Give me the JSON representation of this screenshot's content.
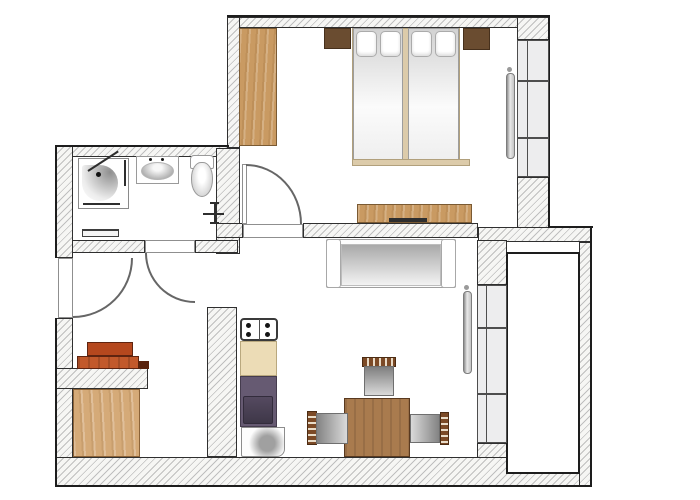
{
  "canvas": {
    "w": 700,
    "h": 500,
    "background": "#ffffff"
  },
  "plan_type": "apartment-floor-plan",
  "palette": {
    "wall_hatch_line": "#bfbfbf",
    "wall_outline": "#2f2f2f",
    "boundary": "#1d1d1d",
    "window_fill": "#ededee",
    "wood_light": "#c99a62",
    "wood_dark": "#6a4c30",
    "table_wood": "#a97b4e",
    "rack_orange": "#c2592b",
    "kitchen_counter": "#ecdcb6",
    "kitchen_purple": "#665a72",
    "radiator_gray": "#8f8f8f",
    "seat_gray": "#838383"
  },
  "elements": [
    {
      "name": "wall-bedroom-top",
      "cls": "wall",
      "x": 227,
      "y": 17,
      "w": 323,
      "h": 11
    },
    {
      "name": "wall-bedroom-top-corner",
      "cls": "wall",
      "x": 517,
      "y": 17,
      "w": 33,
      "h": 23
    },
    {
      "name": "wall-bedroom-left",
      "cls": "wall",
      "x": 227,
      "y": 17,
      "w": 13,
      "h": 131
    },
    {
      "name": "wall-bathroom-top",
      "cls": "wall",
      "x": 64,
      "y": 146,
      "w": 164,
      "h": 11
    },
    {
      "name": "wall-bathroom-right",
      "cls": "wall",
      "x": 216,
      "y": 148,
      "w": 24,
      "h": 106
    },
    {
      "name": "wall-left-upper",
      "cls": "wall",
      "x": 56,
      "y": 146,
      "w": 17,
      "h": 112
    },
    {
      "name": "wall-left-lower",
      "cls": "wall",
      "x": 56,
      "y": 318,
      "w": 17,
      "h": 140
    },
    {
      "name": "wall-bathroom-bottom-left",
      "cls": "wall",
      "x": 72,
      "y": 240,
      "w": 73,
      "h": 13
    },
    {
      "name": "wall-bathroom-bottom-right",
      "cls": "wall",
      "x": 195,
      "y": 240,
      "w": 43,
      "h": 13
    },
    {
      "name": "wall-living-top-left",
      "cls": "wall",
      "x": 216,
      "y": 223,
      "w": 27,
      "h": 15
    },
    {
      "name": "wall-living-top-main",
      "cls": "wall",
      "x": 303,
      "y": 223,
      "w": 175,
      "h": 15
    },
    {
      "name": "wall-connector-right",
      "cls": "wall",
      "x": 478,
      "y": 227,
      "w": 114,
      "h": 15
    },
    {
      "name": "wall-under-bedroom-window",
      "cls": "wall",
      "x": 517,
      "y": 177,
      "w": 33,
      "h": 51
    },
    {
      "name": "wall-balcony-column",
      "cls": "wall",
      "x": 477,
      "y": 240,
      "w": 30,
      "h": 45
    },
    {
      "name": "wall-under-living-window",
      "cls": "wall",
      "x": 477,
      "y": 443,
      "w": 30,
      "h": 15
    },
    {
      "name": "wall-outer-right",
      "cls": "wall",
      "x": 579,
      "y": 242,
      "w": 13,
      "h": 245
    },
    {
      "name": "wall-bottom",
      "cls": "wall",
      "x": 56,
      "y": 457,
      "w": 524,
      "h": 29
    },
    {
      "name": "wall-kitchen-stub",
      "cls": "wall",
      "x": 207,
      "y": 307,
      "w": 30,
      "h": 150
    },
    {
      "name": "wall-shoe-rack",
      "cls": "wall",
      "x": 56,
      "y": 368,
      "w": 92,
      "h": 21
    },
    {
      "name": "balcony-floor",
      "cls": "balcony",
      "x": 506,
      "y": 252,
      "w": 74,
      "h": 222
    },
    {
      "name": "boundary-top",
      "cls": "bline",
      "x": 227,
      "y": 15,
      "w": 323,
      "h": 2
    },
    {
      "name": "boundary-right-upper",
      "cls": "bline",
      "x": 548,
      "y": 15,
      "w": 2,
      "h": 213
    },
    {
      "name": "boundary-step-top",
      "cls": "bline",
      "x": 548,
      "y": 226,
      "w": 45,
      "h": 2
    },
    {
      "name": "boundary-outer-right",
      "cls": "bline",
      "x": 590,
      "y": 226,
      "w": 2,
      "h": 261
    },
    {
      "name": "boundary-bottom",
      "cls": "bline",
      "x": 56,
      "y": 485,
      "w": 536,
      "h": 2
    },
    {
      "name": "boundary-left-upper",
      "cls": "bline",
      "x": 55,
      "y": 145,
      "w": 2,
      "h": 113
    },
    {
      "name": "boundary-left-lower",
      "cls": "bline",
      "x": 55,
      "y": 318,
      "w": 2,
      "h": 169
    },
    {
      "name": "boundary-bathroom-top",
      "cls": "bline",
      "x": 55,
      "y": 145,
      "w": 174,
      "h": 2
    },
    {
      "name": "window-bedroom-cell-1",
      "cls": "wincell",
      "x": 517,
      "y": 40,
      "w": 32,
      "h": 41
    },
    {
      "name": "window-bedroom-cell-2",
      "cls": "wincell",
      "x": 517,
      "y": 81,
      "w": 32,
      "h": 57
    },
    {
      "name": "window-bedroom-cell-3",
      "cls": "wincell",
      "x": 517,
      "y": 138,
      "w": 32,
      "h": 39
    },
    {
      "name": "window-bedroom-mullion",
      "cls": "mull",
      "x": 527,
      "y": 40,
      "w": 1,
      "h": 137
    },
    {
      "name": "window-living-cell-1",
      "cls": "wincell",
      "x": 477,
      "y": 285,
      "w": 30,
      "h": 43
    },
    {
      "name": "window-living-cell-2",
      "cls": "wincell",
      "x": 477,
      "y": 328,
      "w": 30,
      "h": 66
    },
    {
      "name": "window-living-cell-3",
      "cls": "wincell",
      "x": 477,
      "y": 394,
      "w": 30,
      "h": 49
    },
    {
      "name": "window-living-mullion",
      "cls": "mull",
      "x": 486,
      "y": 285,
      "w": 1,
      "h": 158
    },
    {
      "name": "entry-door-leaf",
      "cls": "gap",
      "x": 58,
      "y": 258,
      "w": 15,
      "h": 60
    },
    {
      "name": "bathroom-door-leaf",
      "cls": "gap",
      "x": 145,
      "y": 240,
      "w": 50,
      "h": 13
    },
    {
      "name": "bedroom-door-threshold",
      "cls": "gap",
      "x": 243,
      "y": 224,
      "w": 60,
      "h": 14
    },
    {
      "name": "bedroom-door-leaf",
      "cls": "gap",
      "x": 242,
      "y": 164,
      "w": 5,
      "h": 60
    },
    {
      "name": "entry-door-swing-arc",
      "cls": "arc br",
      "x": 73,
      "y": 258,
      "w": 60,
      "h": 60
    },
    {
      "name": "bathroom-door-swing-arc",
      "cls": "arc bl",
      "x": 145,
      "y": 253,
      "w": 50,
      "h": 50
    },
    {
      "name": "bedroom-door-swing-arc",
      "cls": "arc tr",
      "x": 246,
      "y": 164,
      "w": 56,
      "h": 60
    },
    {
      "name": "radiator-bedroom",
      "cls": "radiator",
      "x": 506,
      "y": 73,
      "w": 9,
      "h": 86
    },
    {
      "name": "radiator-bedroom-valve",
      "cls": "dot-sm",
      "x": 507,
      "y": 67,
      "w": 5,
      "h": 5
    },
    {
      "name": "radiator-living",
      "cls": "radiator",
      "x": 463,
      "y": 291,
      "w": 9,
      "h": 83
    },
    {
      "name": "radiator-living-valve",
      "cls": "dot-sm",
      "x": 464,
      "y": 285,
      "w": 5,
      "h": 5
    },
    {
      "name": "wardrobe",
      "cls": "wood-light",
      "x": 239,
      "y": 28,
      "w": 38,
      "h": 118
    },
    {
      "name": "nightstand-left",
      "cls": "wood-dark",
      "x": 324,
      "y": 28,
      "w": 27,
      "h": 21
    },
    {
      "name": "nightstand-right",
      "cls": "wood-dark",
      "x": 463,
      "y": 28,
      "w": 27,
      "h": 22
    },
    {
      "name": "bed-frame",
      "cls": "bed-frame",
      "x": 352,
      "y": 28,
      "w": 108,
      "h": 137
    },
    {
      "name": "bed-mattress-left",
      "cls": "mattress",
      "x": 353,
      "y": 28,
      "w": 50,
      "h": 132
    },
    {
      "name": "bed-mattress-right",
      "cls": "mattress",
      "x": 408,
      "y": 28,
      "w": 51,
      "h": 132
    },
    {
      "name": "bed-footboard",
      "cls": "bed-frame",
      "x": 352,
      "y": 159,
      "w": 118,
      "h": 7
    },
    {
      "name": "pillow-1",
      "cls": "pillow",
      "x": 356,
      "y": 31,
      "w": 21,
      "h": 26
    },
    {
      "name": "pillow-2",
      "cls": "pillow",
      "x": 380,
      "y": 31,
      "w": 21,
      "h": 26
    },
    {
      "name": "pillow-3",
      "cls": "pillow",
      "x": 411,
      "y": 31,
      "w": 21,
      "h": 26
    },
    {
      "name": "pillow-4",
      "cls": "pillow",
      "x": 435,
      "y": 31,
      "w": 21,
      "h": 26
    },
    {
      "name": "dresser",
      "cls": "wood-light",
      "x": 357,
      "y": 204,
      "w": 115,
      "h": 19
    },
    {
      "name": "dresser-handle",
      "cls": "dark-strip",
      "x": 389,
      "y": 218,
      "w": 38,
      "h": 4
    },
    {
      "name": "sofa-body",
      "cls": "sofa",
      "x": 326,
      "y": 239,
      "w": 130,
      "h": 49
    },
    {
      "name": "sofa-seat",
      "cls": "seat-down-light",
      "x": 341,
      "y": 244,
      "w": 100,
      "h": 42
    },
    {
      "name": "sofa-armrest-left",
      "cls": "sofa-arm",
      "x": 326,
      "y": 239,
      "w": 15,
      "h": 49
    },
    {
      "name": "sofa-armrest-right",
      "cls": "sofa-arm",
      "x": 441,
      "y": 239,
      "w": 15,
      "h": 49
    },
    {
      "name": "stove",
      "cls": "stove",
      "x": 240,
      "y": 318,
      "w": 38,
      "h": 23
    },
    {
      "name": "stove-divider",
      "cls": "mull",
      "x": 259,
      "y": 319,
      "w": 1,
      "h": 21
    },
    {
      "name": "burner-1",
      "cls": "burner",
      "x": 246,
      "y": 323,
      "w": 5,
      "h": 5
    },
    {
      "name": "burner-2",
      "cls": "burner",
      "x": 246,
      "y": 332,
      "w": 5,
      "h": 5
    },
    {
      "name": "burner-3",
      "cls": "burner",
      "x": 265,
      "y": 323,
      "w": 5,
      "h": 5
    },
    {
      "name": "burner-4",
      "cls": "burner",
      "x": 265,
      "y": 332,
      "w": 5,
      "h": 5
    },
    {
      "name": "kitchen-counter",
      "cls": "counter",
      "x": 240,
      "y": 341,
      "w": 37,
      "h": 35
    },
    {
      "name": "kitchen-cabinet-purple",
      "cls": "purple",
      "x": 240,
      "y": 376,
      "w": 37,
      "h": 51
    },
    {
      "name": "kitchen-sink-inset",
      "cls": "purple-inner",
      "x": 243,
      "y": 396,
      "w": 30,
      "h": 28
    },
    {
      "name": "kitchen-appliance",
      "cls": "appliance",
      "x": 241,
      "y": 427,
      "w": 44,
      "h": 30
    },
    {
      "name": "dining-table",
      "cls": "wood-table",
      "x": 344,
      "y": 398,
      "w": 66,
      "h": 59
    },
    {
      "name": "chair-top-backrest",
      "cls": "wood-slats-h",
      "x": 362,
      "y": 357,
      "w": 34,
      "h": 10
    },
    {
      "name": "chair-top-seat",
      "cls": "seat-down",
      "x": 364,
      "y": 366,
      "w": 30,
      "h": 30
    },
    {
      "name": "chair-left-backrest",
      "cls": "wood-slats-v",
      "x": 307,
      "y": 411,
      "w": 10,
      "h": 34
    },
    {
      "name": "chair-left-seat",
      "cls": "seat-right",
      "x": 316,
      "y": 413,
      "w": 32,
      "h": 31
    },
    {
      "name": "chair-right-backrest",
      "cls": "wood-slats-v",
      "x": 440,
      "y": 412,
      "w": 9,
      "h": 33
    },
    {
      "name": "chair-right-seat",
      "cls": "seat-left",
      "x": 410,
      "y": 414,
      "w": 30,
      "h": 29
    },
    {
      "name": "shoe-rack-top",
      "cls": "rack1",
      "x": 87,
      "y": 342,
      "w": 46,
      "h": 14
    },
    {
      "name": "shoe-rack-bottom",
      "cls": "rack2",
      "x": 77,
      "y": 356,
      "w": 62,
      "h": 13
    },
    {
      "name": "shoe-rack-step",
      "cls": "rack3",
      "x": 138,
      "y": 361,
      "w": 11,
      "h": 8
    },
    {
      "name": "hall-cabinet",
      "cls": "wood-light2",
      "x": 73,
      "y": 389,
      "w": 67,
      "h": 68
    },
    {
      "name": "shower-tray",
      "cls": "shower",
      "x": 78,
      "y": 158,
      "w": 51,
      "h": 51
    },
    {
      "name": "shower-spray",
      "cls": "spray",
      "x": 82,
      "y": 165,
      "w": 36,
      "h": 36
    },
    {
      "name": "shower-arm",
      "cls": "dark-strip",
      "x": 88,
      "y": 170,
      "w": 36,
      "h": 2,
      "transform": "rotate(-33deg)"
    },
    {
      "name": "shower-head-dot",
      "cls": "dot-bk",
      "x": 96,
      "y": 172,
      "w": 5,
      "h": 5
    },
    {
      "name": "shower-edge-right",
      "cls": "dark-strip",
      "x": 124,
      "y": 160,
      "w": 2,
      "h": 26
    },
    {
      "name": "shower-edge-bottom",
      "cls": "dark-strip",
      "x": 83,
      "y": 203,
      "w": 37,
      "h": 2
    },
    {
      "name": "sink",
      "cls": "sink",
      "x": 136,
      "y": 156,
      "w": 43,
      "h": 28
    },
    {
      "name": "sink-basin",
      "cls": "basin",
      "x": 141,
      "y": 162,
      "w": 33,
      "h": 18
    },
    {
      "name": "sink-tap-left",
      "cls": "dot-bk",
      "x": 149,
      "y": 158,
      "w": 3,
      "h": 3
    },
    {
      "name": "sink-tap-right",
      "cls": "dot-bk",
      "x": 161,
      "y": 158,
      "w": 3,
      "h": 3
    },
    {
      "name": "toilet-tank",
      "cls": "toilet-tank",
      "x": 190,
      "y": 155,
      "w": 24,
      "h": 14
    },
    {
      "name": "toilet-bowl",
      "cls": "toilet-bowl",
      "x": 191,
      "y": 162,
      "w": 22,
      "h": 35
    },
    {
      "name": "towel-radiator",
      "cls": "towel",
      "x": 82,
      "y": 229,
      "w": 37,
      "h": 8
    },
    {
      "name": "plumbing-cross-vertical",
      "cls": "dark-strip",
      "x": 214,
      "y": 203,
      "w": 2,
      "h": 21
    },
    {
      "name": "plumbing-cross-horizontal",
      "cls": "dark-strip",
      "x": 203,
      "y": 213,
      "w": 21,
      "h": 2
    },
    {
      "name": "plumbing-cross-tick-top",
      "cls": "dark-strip",
      "x": 210,
      "y": 202,
      "w": 9,
      "h": 2
    },
    {
      "name": "plumbing-cross-tick-bottom",
      "cls": "dark-strip",
      "x": 210,
      "y": 222,
      "w": 9,
      "h": 2
    }
  ]
}
